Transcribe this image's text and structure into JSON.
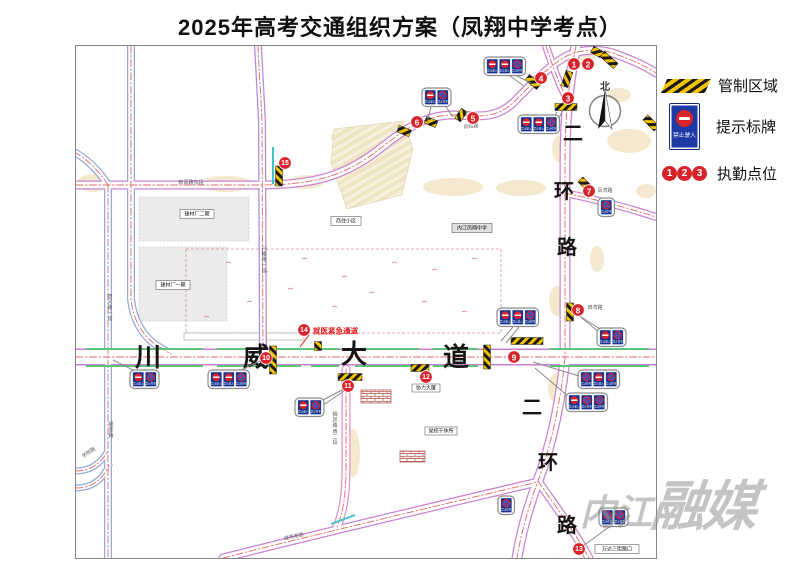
{
  "title": "2025年高考交通组织方案（凤翔中学考点）",
  "legend": {
    "control_area": "管制区域",
    "sign_board": "提示标牌",
    "duty_points": "执勤点位",
    "no_entry_caption": "禁止驶入",
    "sample_numbers": [
      "1",
      "2",
      "3"
    ]
  },
  "watermark": {
    "text_small": "内江",
    "text_large": "融媒"
  },
  "colors": {
    "duty_red": "#d8232a",
    "sign_blue": "#1d3aa5",
    "hatch_yellow": "#f3c200",
    "median_green": "#5cc47c",
    "teal": "#3ec3cf",
    "centerline_red": "#e06868"
  },
  "map": {
    "compass": {
      "label": "北",
      "cx": 604,
      "cy": 110,
      "r": 15.5
    },
    "avenue_chars": [
      {
        "t": "川",
        "x": 147,
        "y": 356
      },
      {
        "t": "威",
        "x": 255,
        "y": 356
      },
      {
        "t": "大",
        "x": 353,
        "y": 353
      },
      {
        "t": "道",
        "x": 455,
        "y": 356
      }
    ],
    "ring_chars": [
      {
        "t": "二",
        "x": 572,
        "y": 133
      },
      {
        "t": "环",
        "x": 563,
        "y": 191
      },
      {
        "t": "路",
        "x": 566,
        "y": 247
      },
      {
        "t": "二",
        "x": 531,
        "y": 407
      },
      {
        "t": "环",
        "x": 547,
        "y": 462
      },
      {
        "t": "路",
        "x": 566,
        "y": 525
      }
    ],
    "emergency": {
      "text": "就医紧急通道",
      "tx": 312,
      "ty": 330,
      "lx1": 308,
      "ly1": 334,
      "lx2": 299,
      "ly2": 346
    },
    "duty_points": [
      {
        "n": "1",
        "x": 573,
        "y": 63
      },
      {
        "n": "2",
        "x": 587,
        "y": 63
      },
      {
        "n": "3",
        "x": 567,
        "y": 97
      },
      {
        "n": "4",
        "x": 540,
        "y": 77
      },
      {
        "n": "5",
        "x": 472,
        "y": 117
      },
      {
        "n": "6",
        "x": 416,
        "y": 121
      },
      {
        "n": "7",
        "x": 588,
        "y": 190
      },
      {
        "n": "8",
        "x": 577,
        "y": 309
      },
      {
        "n": "9",
        "x": 513,
        "y": 356
      },
      {
        "n": "10",
        "x": 265,
        "y": 357
      },
      {
        "n": "11",
        "x": 347,
        "y": 385
      },
      {
        "n": "12",
        "x": 425,
        "y": 376
      },
      {
        "n": "13",
        "x": 578,
        "y": 548
      },
      {
        "n": "14",
        "x": 303,
        "y": 329
      },
      {
        "n": "15",
        "x": 284,
        "y": 162
      }
    ],
    "roads": [
      {
        "d": "M75,184 L258,184 C310,184 342,176 376,150 C398,133 420,114 452,114 C472,114 492,120 512,102 C526,88 542,70 562,57 C575,49 595,47 612,52 C628,58 643,64 655,72",
        "c": "#c985cf",
        "cw": 9,
        "fw": 6.5
      },
      {
        "d": "M575,45 C569,75 564,110 564,160 L564,356",
        "c": "#c985cf",
        "cw": 11,
        "fw": 8.5
      },
      {
        "d": "M564,356 C560,400 550,445 537,480 C528,504 520,532 516,557",
        "c": "#c985cf",
        "cw": 11,
        "fw": 8.5
      },
      {
        "d": "M537,480 C552,502 572,528 588,557",
        "c": "#c985cf",
        "cw": 9,
        "fw": 6.5
      },
      {
        "d": "M222,557 C300,537 460,499 537,481",
        "c": "#c985cf",
        "cw": 9,
        "fw": 6.5
      },
      {
        "d": "M545,45 C552,66 558,83 566,98",
        "c": "#c985cf",
        "cw": 8,
        "fw": 5.5
      },
      {
        "d": "M564,192 C592,198 625,206 655,216",
        "c": "#c985cf",
        "cw": 8,
        "fw": 5.5
      },
      {
        "d": "M107,184 C98,170 88,160 75,152",
        "c": "#95a8da",
        "cw": 8,
        "fw": 5.5
      },
      {
        "d": "M107,184 L107,557",
        "c": "#95a8da",
        "cw": 8,
        "fw": 5.5
      },
      {
        "d": "M130,45 L130,298 C132,318 141,334 155,344 L170,353",
        "c": "#95a8da",
        "cw": 8,
        "fw": 5.5
      },
      {
        "d": "M257,45 L261,120 L262,356",
        "c": "#ab8ed6",
        "cw": 8,
        "fw": 5.5
      },
      {
        "d": "M345,368 L345,468 C345,494 342,511 336,526",
        "c": "#e08fd0",
        "cw": 9,
        "fw": 6.5
      },
      {
        "d": "M75,470 C90,470 100,462 107,450",
        "c": "#95a8da",
        "cw": 7,
        "fw": 4.5
      },
      {
        "d": "M75,487 C92,487 103,477 108,464",
        "c": "#95a8da",
        "cw": 7,
        "fw": 4.5
      },
      {
        "d": "M75,356 L655,356",
        "c": "#c97fd0",
        "cw": 17,
        "fw": 14
      }
    ],
    "green_lines": [
      [
        85,
        348,
        202,
        348
      ],
      [
        216,
        348,
        256,
        348
      ],
      [
        272,
        348,
        338,
        348
      ],
      [
        354,
        348,
        418,
        348
      ],
      [
        432,
        348,
        477,
        348
      ],
      [
        549,
        348,
        648,
        348
      ],
      [
        85,
        365,
        202,
        365
      ],
      [
        216,
        365,
        300,
        365
      ],
      [
        310,
        365,
        338,
        365
      ],
      [
        354,
        365,
        420,
        365
      ],
      [
        432,
        365,
        477,
        365
      ],
      [
        549,
        365,
        648,
        365
      ]
    ],
    "teal_lines": [
      [
        272,
        146,
        272,
        183
      ],
      [
        330,
        523,
        354,
        514
      ]
    ],
    "hatches": [
      {
        "x": 608,
        "y": 59,
        "len": 18,
        "rot": 42
      },
      {
        "x": 566,
        "y": 78,
        "len": 16,
        "rot": -72
      },
      {
        "x": 565,
        "y": 106,
        "len": 22,
        "rot": 0
      },
      {
        "x": 532,
        "y": 81,
        "len": 15,
        "rot": 40
      },
      {
        "x": 460,
        "y": 114,
        "len": 12,
        "rot": -55
      },
      {
        "x": 403,
        "y": 130,
        "len": 13,
        "rot": 22
      },
      {
        "x": 430,
        "y": 121,
        "len": 12,
        "rot": 22
      },
      {
        "x": 278,
        "y": 175,
        "len": 20,
        "rot": 90
      },
      {
        "x": 584,
        "y": 183,
        "len": 13,
        "rot": 45
      },
      {
        "x": 569,
        "y": 311,
        "len": 18,
        "rot": 90
      },
      {
        "x": 272,
        "y": 359,
        "len": 28,
        "rot": 90
      },
      {
        "x": 317,
        "y": 345,
        "len": 9,
        "rot": 90
      },
      {
        "x": 526,
        "y": 340,
        "len": 32,
        "rot": 0
      },
      {
        "x": 486,
        "y": 356,
        "len": 24,
        "rot": 90
      },
      {
        "x": 349,
        "y": 376,
        "len": 24,
        "rot": 0
      },
      {
        "x": 419,
        "y": 367,
        "len": 18,
        "rot": 0
      },
      {
        "x": 650,
        "y": 122,
        "len": 16,
        "rot": 45
      },
      {
        "x": 596,
        "y": 51,
        "len": 11,
        "rot": 30
      }
    ],
    "sign_captions": {
      "entry": "禁止驶入",
      "park": "禁止停车"
    },
    "sign_groups": [
      {
        "x": 483,
        "y": 56,
        "signs": [
          "entry",
          "entry",
          "park"
        ],
        "leaders": [
          [
            516,
            75,
            530,
            82
          ],
          [
            509,
            75,
            523,
            85
          ]
        ]
      },
      {
        "x": 421,
        "y": 87,
        "signs": [
          "entry",
          "park"
        ],
        "leaders": [
          [
            430,
            106,
            426,
            122
          ],
          [
            445,
            106,
            452,
            116
          ]
        ]
      },
      {
        "x": 517,
        "y": 114,
        "signs": [
          "entry",
          "entry",
          "park"
        ],
        "leaders": [
          [
            550,
            133,
            562,
            109
          ],
          [
            543,
            133,
            556,
            111
          ]
        ]
      },
      {
        "x": 129,
        "y": 369,
        "signs": [
          "entry",
          "park"
        ],
        "leaders": [
          [
            132,
            369,
            112,
            359
          ]
        ]
      },
      {
        "x": 207,
        "y": 369,
        "signs": [
          "entry",
          "entry",
          "park"
        ],
        "leaders": [
          [
            240,
            369,
            261,
            359
          ]
        ]
      },
      {
        "x": 294,
        "y": 397,
        "signs": [
          "entry",
          "park"
        ],
        "leaders": [
          [
            320,
            400,
            343,
            388
          ],
          [
            318,
            407,
            343,
            390
          ]
        ]
      },
      {
        "x": 496,
        "y": 307,
        "signs": [
          "entry",
          "entry",
          "park"
        ],
        "leaders": [
          [
            512,
            326,
            500,
            340
          ],
          [
            518,
            326,
            505,
            342
          ]
        ]
      },
      {
        "x": 596,
        "y": 327,
        "signs": [
          "entry",
          "park"
        ],
        "leaders": [
          [
            598,
            331,
            576,
            313
          ],
          [
            604,
            331,
            580,
            316
          ]
        ]
      },
      {
        "x": 577,
        "y": 369,
        "signs": [
          "park",
          "entry",
          "park"
        ],
        "leaders": [
          [
            578,
            375,
            532,
            361
          ]
        ]
      },
      {
        "x": 565,
        "y": 392,
        "signs": [
          "entry",
          "park",
          "park"
        ],
        "leaders": [
          [
            568,
            396,
            534,
            367
          ]
        ]
      },
      {
        "x": 598,
        "y": 507,
        "signs": [
          "park",
          "park"
        ],
        "leaders": [
          [
            608,
            526,
            582,
            545
          ]
        ]
      },
      {
        "x": 497,
        "y": 495,
        "signs": [
          "park"
        ],
        "leaders": []
      },
      {
        "x": 597,
        "y": 197,
        "signs": [
          "park"
        ],
        "leaders": []
      }
    ],
    "labels_boxed": [
      {
        "t": "建材厂二期",
        "x": 196,
        "y": 213,
        "w": 34,
        "h": 9
      },
      {
        "t": "建材厂一期",
        "x": 172,
        "y": 284,
        "w": 34,
        "h": 9
      },
      {
        "t": "商住小区",
        "x": 345,
        "y": 220,
        "w": 30,
        "h": 9
      },
      {
        "t": "内江凤翔中学",
        "x": 471,
        "y": 227,
        "w": 40,
        "h": 9,
        "bg": "#e2e2e2"
      },
      {
        "t": "协力大厦",
        "x": 425,
        "y": 387,
        "w": 28,
        "h": 8
      },
      {
        "t": "党校干休所",
        "x": 440,
        "y": 430,
        "w": 32,
        "h": 8
      },
      {
        "t": "万达三街路口",
        "x": 616,
        "y": 548,
        "w": 44,
        "h": 9
      }
    ],
    "labels_road": [
      {
        "t": "新凤路东段",
        "x": 190,
        "y": 182,
        "rot": 0
      },
      {
        "t": "凤鸣路",
        "x": 470,
        "y": 126,
        "rot": -6
      },
      {
        "t": "凤湾路",
        "x": 604,
        "y": 190,
        "rot": 0
      },
      {
        "t": "田湾路",
        "x": 594,
        "y": 307,
        "rot": 0
      },
      {
        "t": "峰鸣老路",
        "x": 293,
        "y": 536,
        "rot": -13
      },
      {
        "t": "学院路",
        "x": 88,
        "y": 452,
        "rot": -35
      },
      {
        "t": "智义路一段",
        "x": 109,
        "y": 296,
        "vert": true
      },
      {
        "t": "兴隆路一段",
        "x": 263,
        "y": 248,
        "vert": true
      },
      {
        "t": "栖凤路西二段",
        "x": 334,
        "y": 414,
        "vert": true
      },
      {
        "t": "银家路",
        "x": 110,
        "y": 424,
        "vert": true
      }
    ],
    "areas": {
      "gray_rects": [
        [
          138,
          196,
          110,
          44
        ],
        [
          138,
          246,
          88,
          74
        ]
      ],
      "dashed_rect": [
        185,
        248,
        315,
        84
      ],
      "tan_ellipses": [
        [
          92,
          182,
          16,
          9
        ],
        [
          225,
          183,
          28,
          8
        ],
        [
          305,
          181,
          18,
          7
        ],
        [
          452,
          186,
          30,
          9
        ],
        [
          520,
          187,
          25,
          8
        ],
        [
          560,
          148,
          9,
          14
        ],
        [
          628,
          140,
          22,
          12
        ],
        [
          596,
          258,
          7,
          13
        ],
        [
          556,
          300,
          8,
          15
        ],
        [
          372,
          162,
          28,
          17
        ],
        [
          348,
          136,
          18,
          9
        ],
        [
          556,
          387,
          9,
          15
        ],
        [
          352,
          452,
          7,
          24
        ],
        [
          618,
          94,
          12,
          7
        ],
        [
          584,
          55,
          10,
          6
        ],
        [
          645,
          190,
          10,
          7
        ]
      ],
      "parking_poly": "333,128 402,120 412,148 401,194 346,208 330,162",
      "brick_rects": [
        [
          360,
          389,
          30,
          13
        ],
        [
          399,
          450,
          25,
          11
        ]
      ],
      "building_rect": [
        183,
        332,
        120,
        7
      ],
      "scatter": [
        [
          225,
          262
        ],
        [
          262,
          271
        ],
        [
          301,
          258
        ],
        [
          341,
          276
        ],
        [
          391,
          262
        ],
        [
          431,
          269
        ],
        [
          471,
          258
        ],
        [
          246,
          301
        ],
        [
          331,
          306
        ],
        [
          421,
          301
        ],
        [
          461,
          311
        ],
        [
          203,
          316
        ],
        [
          287,
          288
        ],
        [
          368,
          292
        ]
      ]
    }
  }
}
